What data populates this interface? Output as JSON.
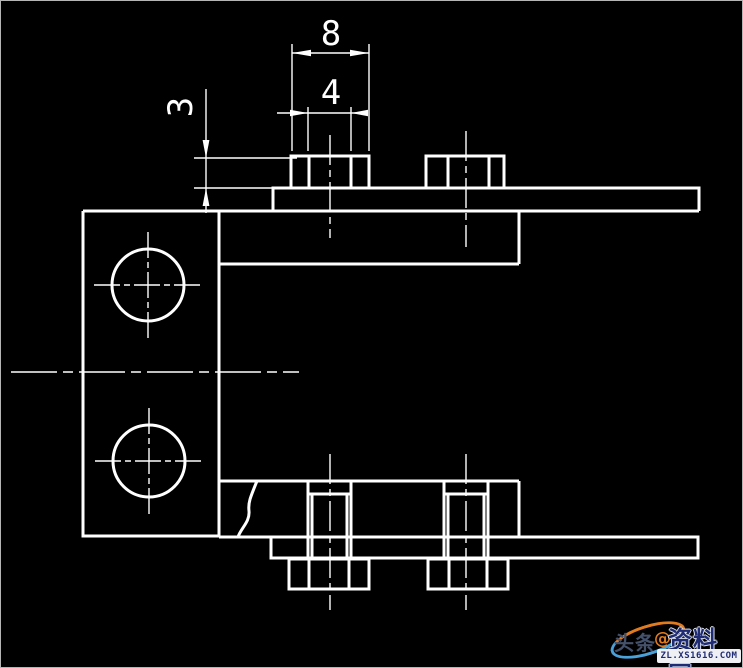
{
  "canvas": {
    "background": "#000000",
    "line_color": "#ffffff",
    "frame_color": "#b5b5b5"
  },
  "drawing": {
    "type": "CAD side view of a clamp bracket with bolted plates",
    "dimension_labels": {
      "nut_width": "8",
      "hole_width": "4",
      "nut_height": "3"
    }
  },
  "watermark": {
    "prefix": "头条",
    "at_symbol": "@",
    "site": "资料网",
    "url": "ZL.XS1616.COM",
    "colors": {
      "navy": "#1f2c74",
      "orange": "#e07b1f",
      "light_blue": "#4aa0d8",
      "gray_text": "#44516b",
      "bar_background": "#eef0f4"
    }
  }
}
